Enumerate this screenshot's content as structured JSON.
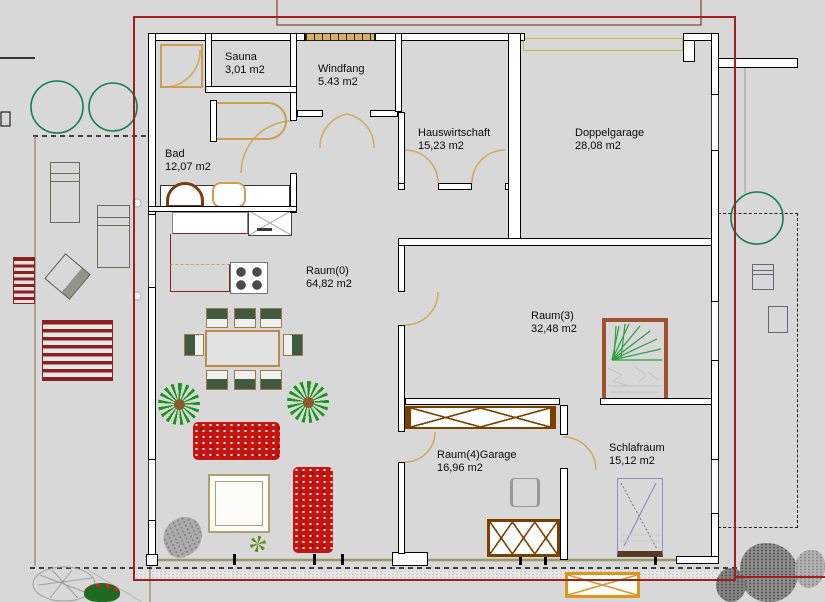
{
  "drawing": {
    "type": "architectural floor plan",
    "language": "de"
  },
  "rooms": [
    {
      "name": "Sauna",
      "area": "3,01 m2"
    },
    {
      "name": "Windfang",
      "area": "5.43 m2"
    },
    {
      "name": "Hauswirtschaft",
      "area": "15,23 m2"
    },
    {
      "name": "Doppelgarage",
      "area": "28,08 m2"
    },
    {
      "name": "Bad",
      "area": "12,07 m2"
    },
    {
      "name": "Raum(0)",
      "area": "64,82 m2"
    },
    {
      "name": "Raum(3)",
      "area": "32,48 m2"
    },
    {
      "name": "Raum(4)Garage",
      "area": "16,96 m2"
    },
    {
      "name": "Schlafraum",
      "area": "15,12 m2"
    }
  ],
  "colors": {
    "background": "#d8d8d8",
    "wall_line": "#000000",
    "wall_fill": "#ffffff",
    "door_arc_tan": "#d0ab5e",
    "boundary_red": "#a02020",
    "garage_door_yellow": "#c9bc2f",
    "window_band_tan": "#d8b068",
    "glass_front_olive": "#9a9a5f",
    "sofa_red": "#c41510",
    "plant_green": "#17961c",
    "tree_outline_green": "#0f8050",
    "furniture_brown": "#7b3f00",
    "bed_frame_brown": "#a0522d",
    "bed_outline_violet": "#8f8fc0",
    "outdoor_table_orange": "#e0951e",
    "kitchen_counter_red": "#8b2020",
    "fixture_tan": "#c8a050",
    "bench_dark_red": "#8b2020"
  },
  "furniture": [
    "shower",
    "bathtub",
    "washbasin-vanity",
    "toilet",
    "kitchen-sink",
    "dishwasher",
    "stove",
    "kitchen-island",
    "dining-table",
    "dining-chair",
    "potted-plant",
    "sofa",
    "coffee-table",
    "recliner",
    "double-bed",
    "sideboard",
    "desk-chair",
    "wardrobe",
    "single-bed",
    "outdoor-table",
    "tree",
    "sun-lounger",
    "striped-armchair",
    "tilted-garden-chair",
    "picnic-bench",
    "garden-bush",
    "flower-bush",
    "rocks"
  ]
}
